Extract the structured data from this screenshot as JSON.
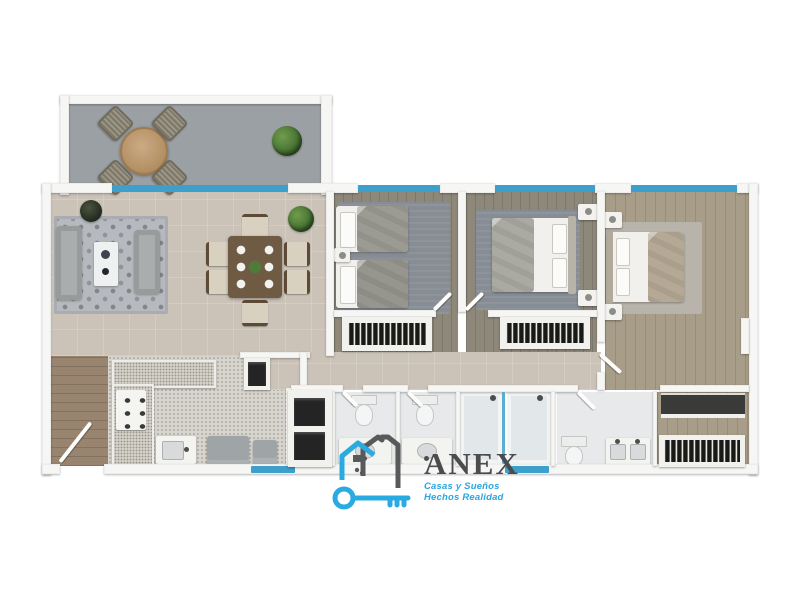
{
  "logo": {
    "name": "ANEX",
    "tagline_line1": "Casas y Sueños",
    "tagline_line2": "Hechos Realidad",
    "icon": "house-and-key-icon"
  },
  "colors": {
    "brand-blue": "#29abe2",
    "brand-gray": "#4b4c4e",
    "tagline-blue": "#2ba6df",
    "window-blue": "#3d9fcb",
    "wall-white": "#f6f6f4",
    "floor-tile": "#cbc3b8",
    "floor-terrace": "#9ba0a4",
    "floor-wood-dark": "#8e887a",
    "floor-wood-light": "#a89d88",
    "floor-kitchen": "#d8d5ce",
    "floor-entry": "#98846f",
    "floor-bath": "#e7e9ea",
    "rug-dark": "#878d94",
    "rug-light": "#b9b4ab",
    "sofa-gray": "#a9adae",
    "appliance-gray": "#9fa4a6",
    "table-wood": "#6f5a43",
    "plant-green": "#4e7b3a"
  },
  "floorplan": {
    "type": "apartment-floor-plan-3d-render",
    "rooms": [
      {
        "name": "terrace",
        "furniture": [
          "round table",
          "4 woven chairs",
          "plant"
        ]
      },
      {
        "name": "living-room",
        "furniture": [
          "2 gray sofas",
          "coffee table",
          "patterned rug",
          "plant"
        ]
      },
      {
        "name": "dining-room",
        "furniture": [
          "wood table",
          "6 chairs",
          "plates",
          "centerpiece",
          "plant"
        ]
      },
      {
        "name": "kitchen",
        "furniture": [
          "L-shaped granite counter",
          "stove",
          "sink",
          "washer",
          "window"
        ]
      },
      {
        "name": "entry",
        "furniture": [
          "entrance door"
        ]
      },
      {
        "name": "bedroom-1",
        "furniture": [
          "2 single beds",
          "nightstand",
          "rug",
          "closet with hangers",
          "window"
        ]
      },
      {
        "name": "bedroom-2",
        "furniture": [
          "double bed",
          "2 nightstands",
          "rug",
          "closet with hangers",
          "window"
        ]
      },
      {
        "name": "master-bedroom",
        "furniture": [
          "double bed",
          "2 nightstands",
          "rug",
          "window"
        ]
      },
      {
        "name": "bathroom-1",
        "furniture": [
          "toilet",
          "vanity sink"
        ]
      },
      {
        "name": "bathroom-2",
        "furniture": [
          "toilet",
          "vanity sink"
        ]
      },
      {
        "name": "shower-room",
        "furniture": [
          "2 shower stalls",
          "glass partition",
          "window"
        ]
      },
      {
        "name": "master-bathroom",
        "furniture": [
          "toilet",
          "double vanity"
        ]
      },
      {
        "name": "master-closet",
        "furniture": [
          "dresser",
          "hanging closet"
        ]
      },
      {
        "name": "hallway",
        "furniture": [
          "linen cabinet",
          "small closet"
        ]
      }
    ]
  }
}
